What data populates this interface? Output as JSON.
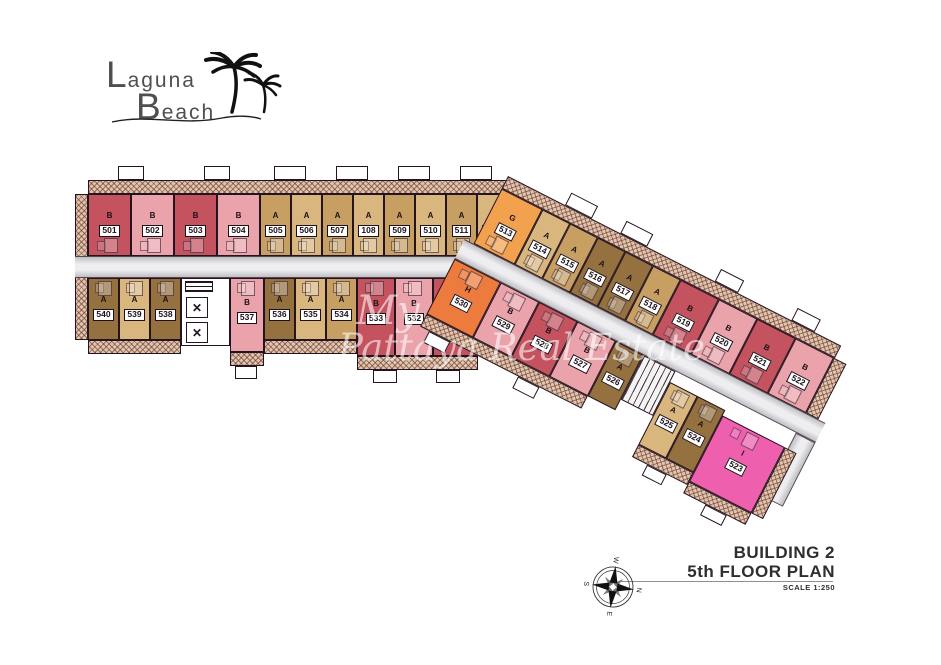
{
  "logo": {
    "word1_initial": "L",
    "word1_rest": "aguna",
    "word2_initial": "B",
    "word2_rest": "each"
  },
  "watermark": {
    "line1": "My",
    "line2": "Pattaya Real Estate"
  },
  "title_block": {
    "building": "BUILDING 2",
    "floor": "5th FLOOR PLAN",
    "scale": "SCALE 1:250"
  },
  "compass": {
    "north": "N",
    "east": "E",
    "south": "S",
    "west": "W"
  },
  "icons": {
    "elevator": "✕"
  },
  "colors": {
    "unit_red": "#c4525f",
    "unit_pink": "#eba3ab",
    "unit_tan": "#c79f63",
    "unit_tan_light": "#d8b67e",
    "unit_tan_dark": "#95713f",
    "unit_orange": "#f2a14e",
    "unit_orange_deep": "#ee7b3e",
    "unit_magenta": "#ee5fae",
    "corridor_gray": "#c6c6ca",
    "hatch_base": "#d9c9ae",
    "outline": "#241420"
  },
  "units": {
    "501": {
      "number": "501",
      "type": "B"
    },
    "502": {
      "number": "502",
      "type": "B"
    },
    "503": {
      "number": "503",
      "type": "B"
    },
    "504": {
      "number": "504",
      "type": "B"
    },
    "505": {
      "number": "505",
      "type": "A"
    },
    "506": {
      "number": "506",
      "type": "A"
    },
    "507": {
      "number": "507",
      "type": "A"
    },
    "108": {
      "number": "108",
      "type": "A"
    },
    "509": {
      "number": "509",
      "type": "A"
    },
    "510": {
      "number": "510",
      "type": "A"
    },
    "511": {
      "number": "511",
      "type": "A"
    },
    "512": {
      "number": "512",
      "type": "A"
    },
    "513": {
      "number": "513",
      "type": "G"
    },
    "514": {
      "number": "514",
      "type": "A"
    },
    "515": {
      "number": "515",
      "type": "A"
    },
    "516": {
      "number": "516",
      "type": "A"
    },
    "517": {
      "number": "517",
      "type": "A"
    },
    "518": {
      "number": "518",
      "type": "A"
    },
    "519": {
      "number": "519",
      "type": "B"
    },
    "520": {
      "number": "520",
      "type": "B"
    },
    "521": {
      "number": "521",
      "type": "B"
    },
    "522": {
      "number": "522",
      "type": "B"
    },
    "523": {
      "number": "523",
      "type": "I"
    },
    "524": {
      "number": "524",
      "type": "A"
    },
    "525": {
      "number": "525",
      "type": "A"
    },
    "526": {
      "number": "526",
      "type": "A"
    },
    "527": {
      "number": "527",
      "type": "B"
    },
    "528": {
      "number": "528",
      "type": "B"
    },
    "529": {
      "number": "529",
      "type": "B"
    },
    "530": {
      "number": "530",
      "type": "H"
    },
    "531": {
      "number": "531",
      "type": "B"
    },
    "532": {
      "number": "532",
      "type": "B"
    },
    "533": {
      "number": "533",
      "type": "B"
    },
    "534": {
      "number": "534",
      "type": "A"
    },
    "535": {
      "number": "535",
      "type": "A"
    },
    "536": {
      "number": "536",
      "type": "A"
    },
    "537": {
      "number": "537",
      "type": "B"
    },
    "538": {
      "number": "538",
      "type": "A"
    },
    "539": {
      "number": "539",
      "type": "A"
    },
    "540": {
      "number": "540",
      "type": "A"
    }
  }
}
